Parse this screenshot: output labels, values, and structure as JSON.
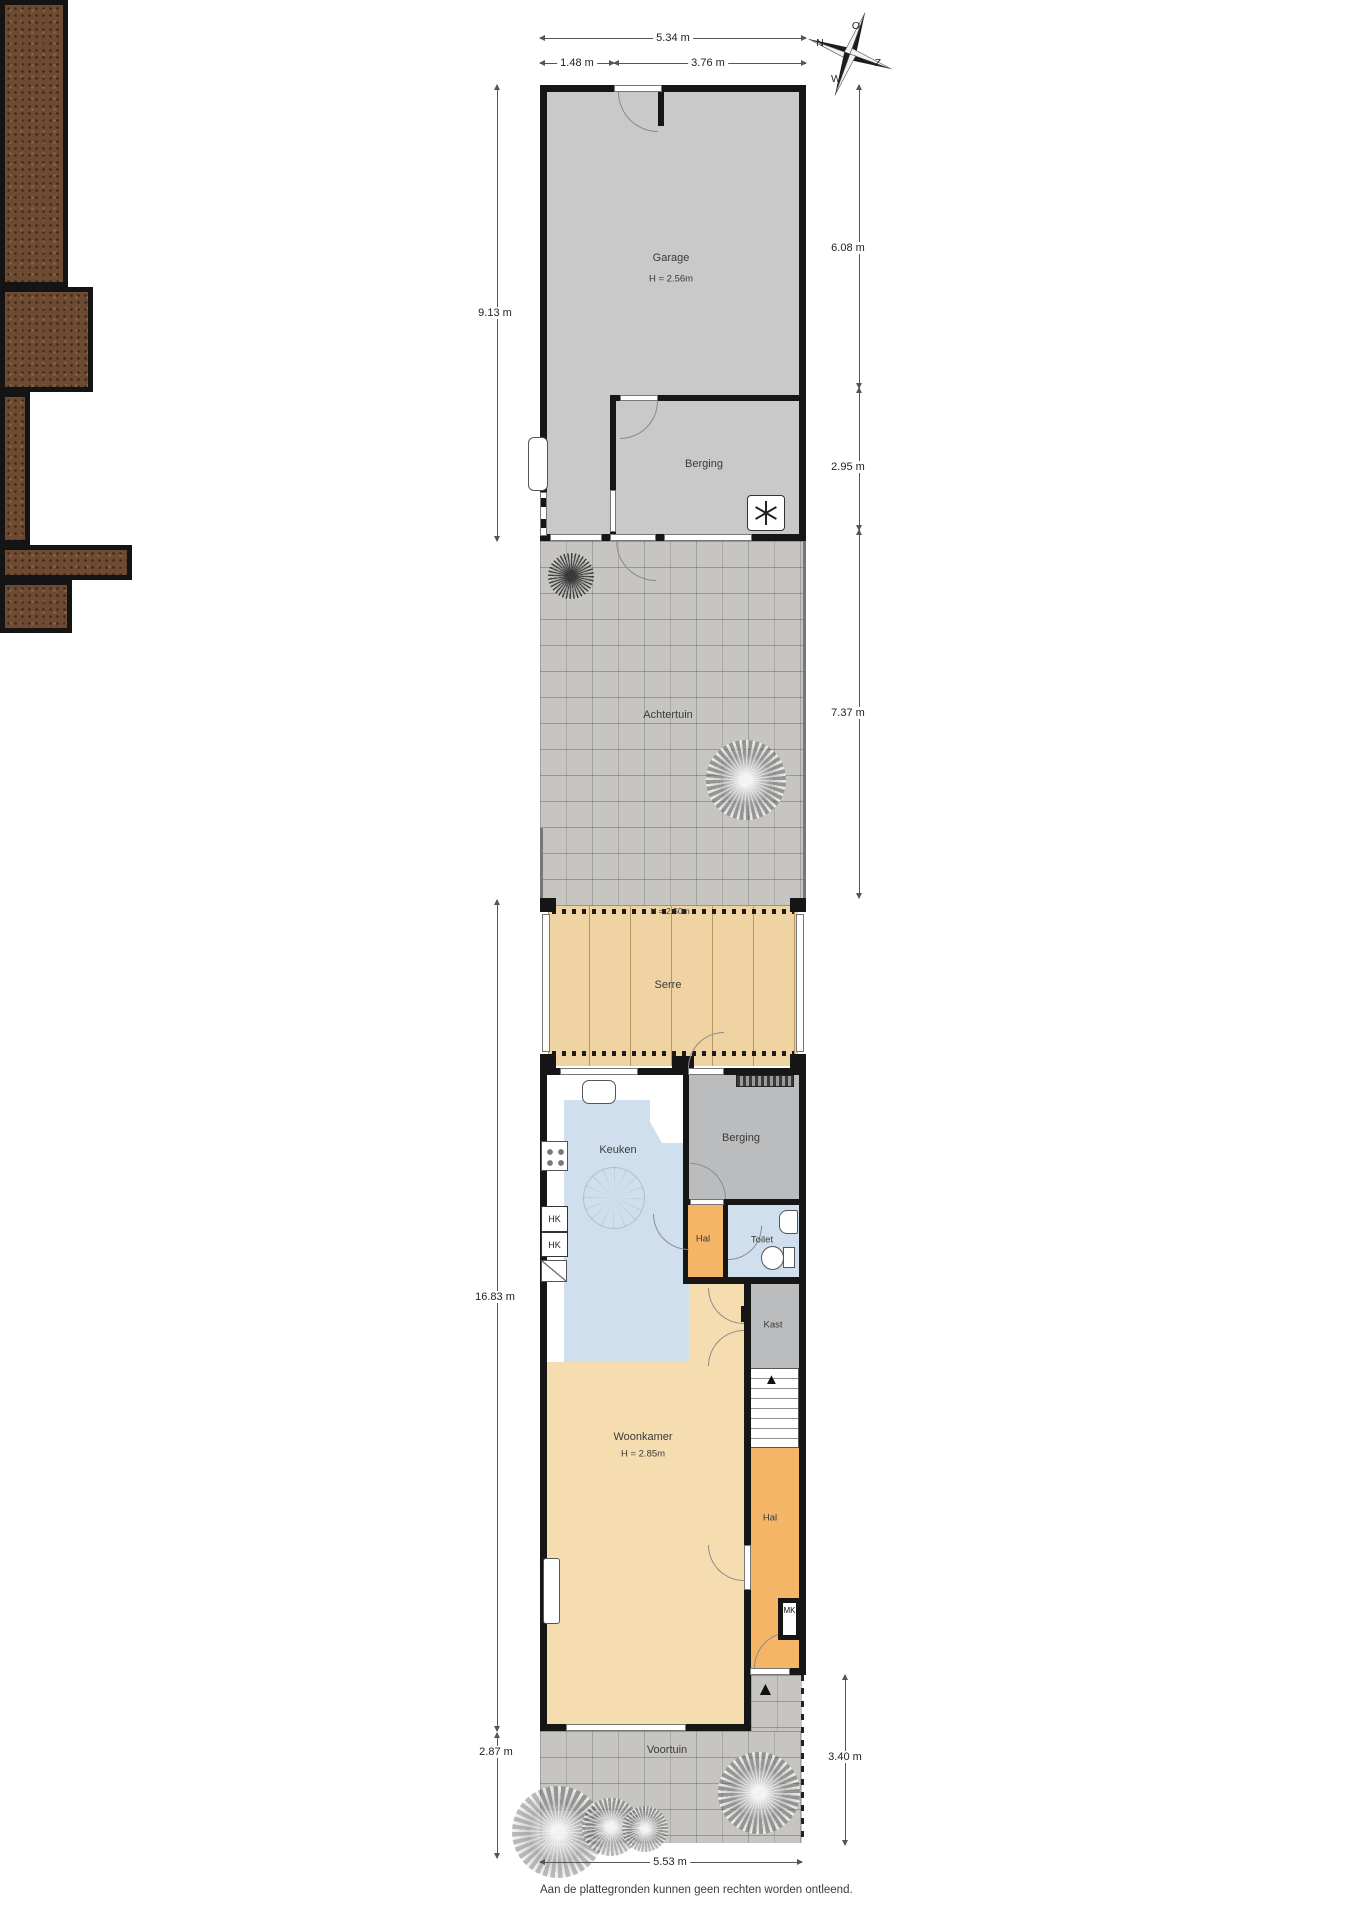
{
  "compass": {
    "north": "N",
    "east": "O",
    "south": "Z",
    "west": "W"
  },
  "rooms": {
    "garage": {
      "name": "Garage",
      "ceiling": "H = 2.56m"
    },
    "berging_garage": {
      "name": "Berging"
    },
    "achtertuin": {
      "name": "Achtertuin"
    },
    "serre": {
      "name": "Serre",
      "ceiling": "H = 2.50m"
    },
    "keuken": {
      "name": "Keuken"
    },
    "berging_huis": {
      "name": "Berging"
    },
    "hal_midden": {
      "name": "Hal"
    },
    "toilet": {
      "name": "Toilet"
    },
    "kast": {
      "name": "Kast"
    },
    "woonkamer": {
      "name": "Woonkamer",
      "ceiling": "H = 2.85m"
    },
    "hal_entree": {
      "name": "Hal"
    },
    "voortuin": {
      "name": "Voortuin"
    }
  },
  "closets": {
    "hk_boven": "HK",
    "hk_onder": "HK",
    "meterkast": "MK"
  },
  "dimensions": {
    "top_total": "5.34 m",
    "top_left": "1.48 m",
    "top_right": "3.76 m",
    "left_garage": "9.13 m",
    "left_woning": "16.83 m",
    "left_voortuin": "2.87 m",
    "right_garage": "6.08 m",
    "right_berging": "2.95 m",
    "right_achtertuin": "7.37 m",
    "right_voortuin": "3.40 m",
    "bottom_total": "5.53 m"
  },
  "footer": "Aan de plattegronden kunnen geen rechten worden ontleend.",
  "colors": {
    "wall": "#161616",
    "garage_floor": "#c9c9c9",
    "berging_floor": "#bbbcbe",
    "tuin_paving": "#c6c5c1",
    "soil": "#6e4a33",
    "serre_floor": "#f0d3a2",
    "keuken_floor": "#cfdfee",
    "hal_floor": "#f4b566",
    "woonkamer_floor": "#f6ddb0"
  }
}
